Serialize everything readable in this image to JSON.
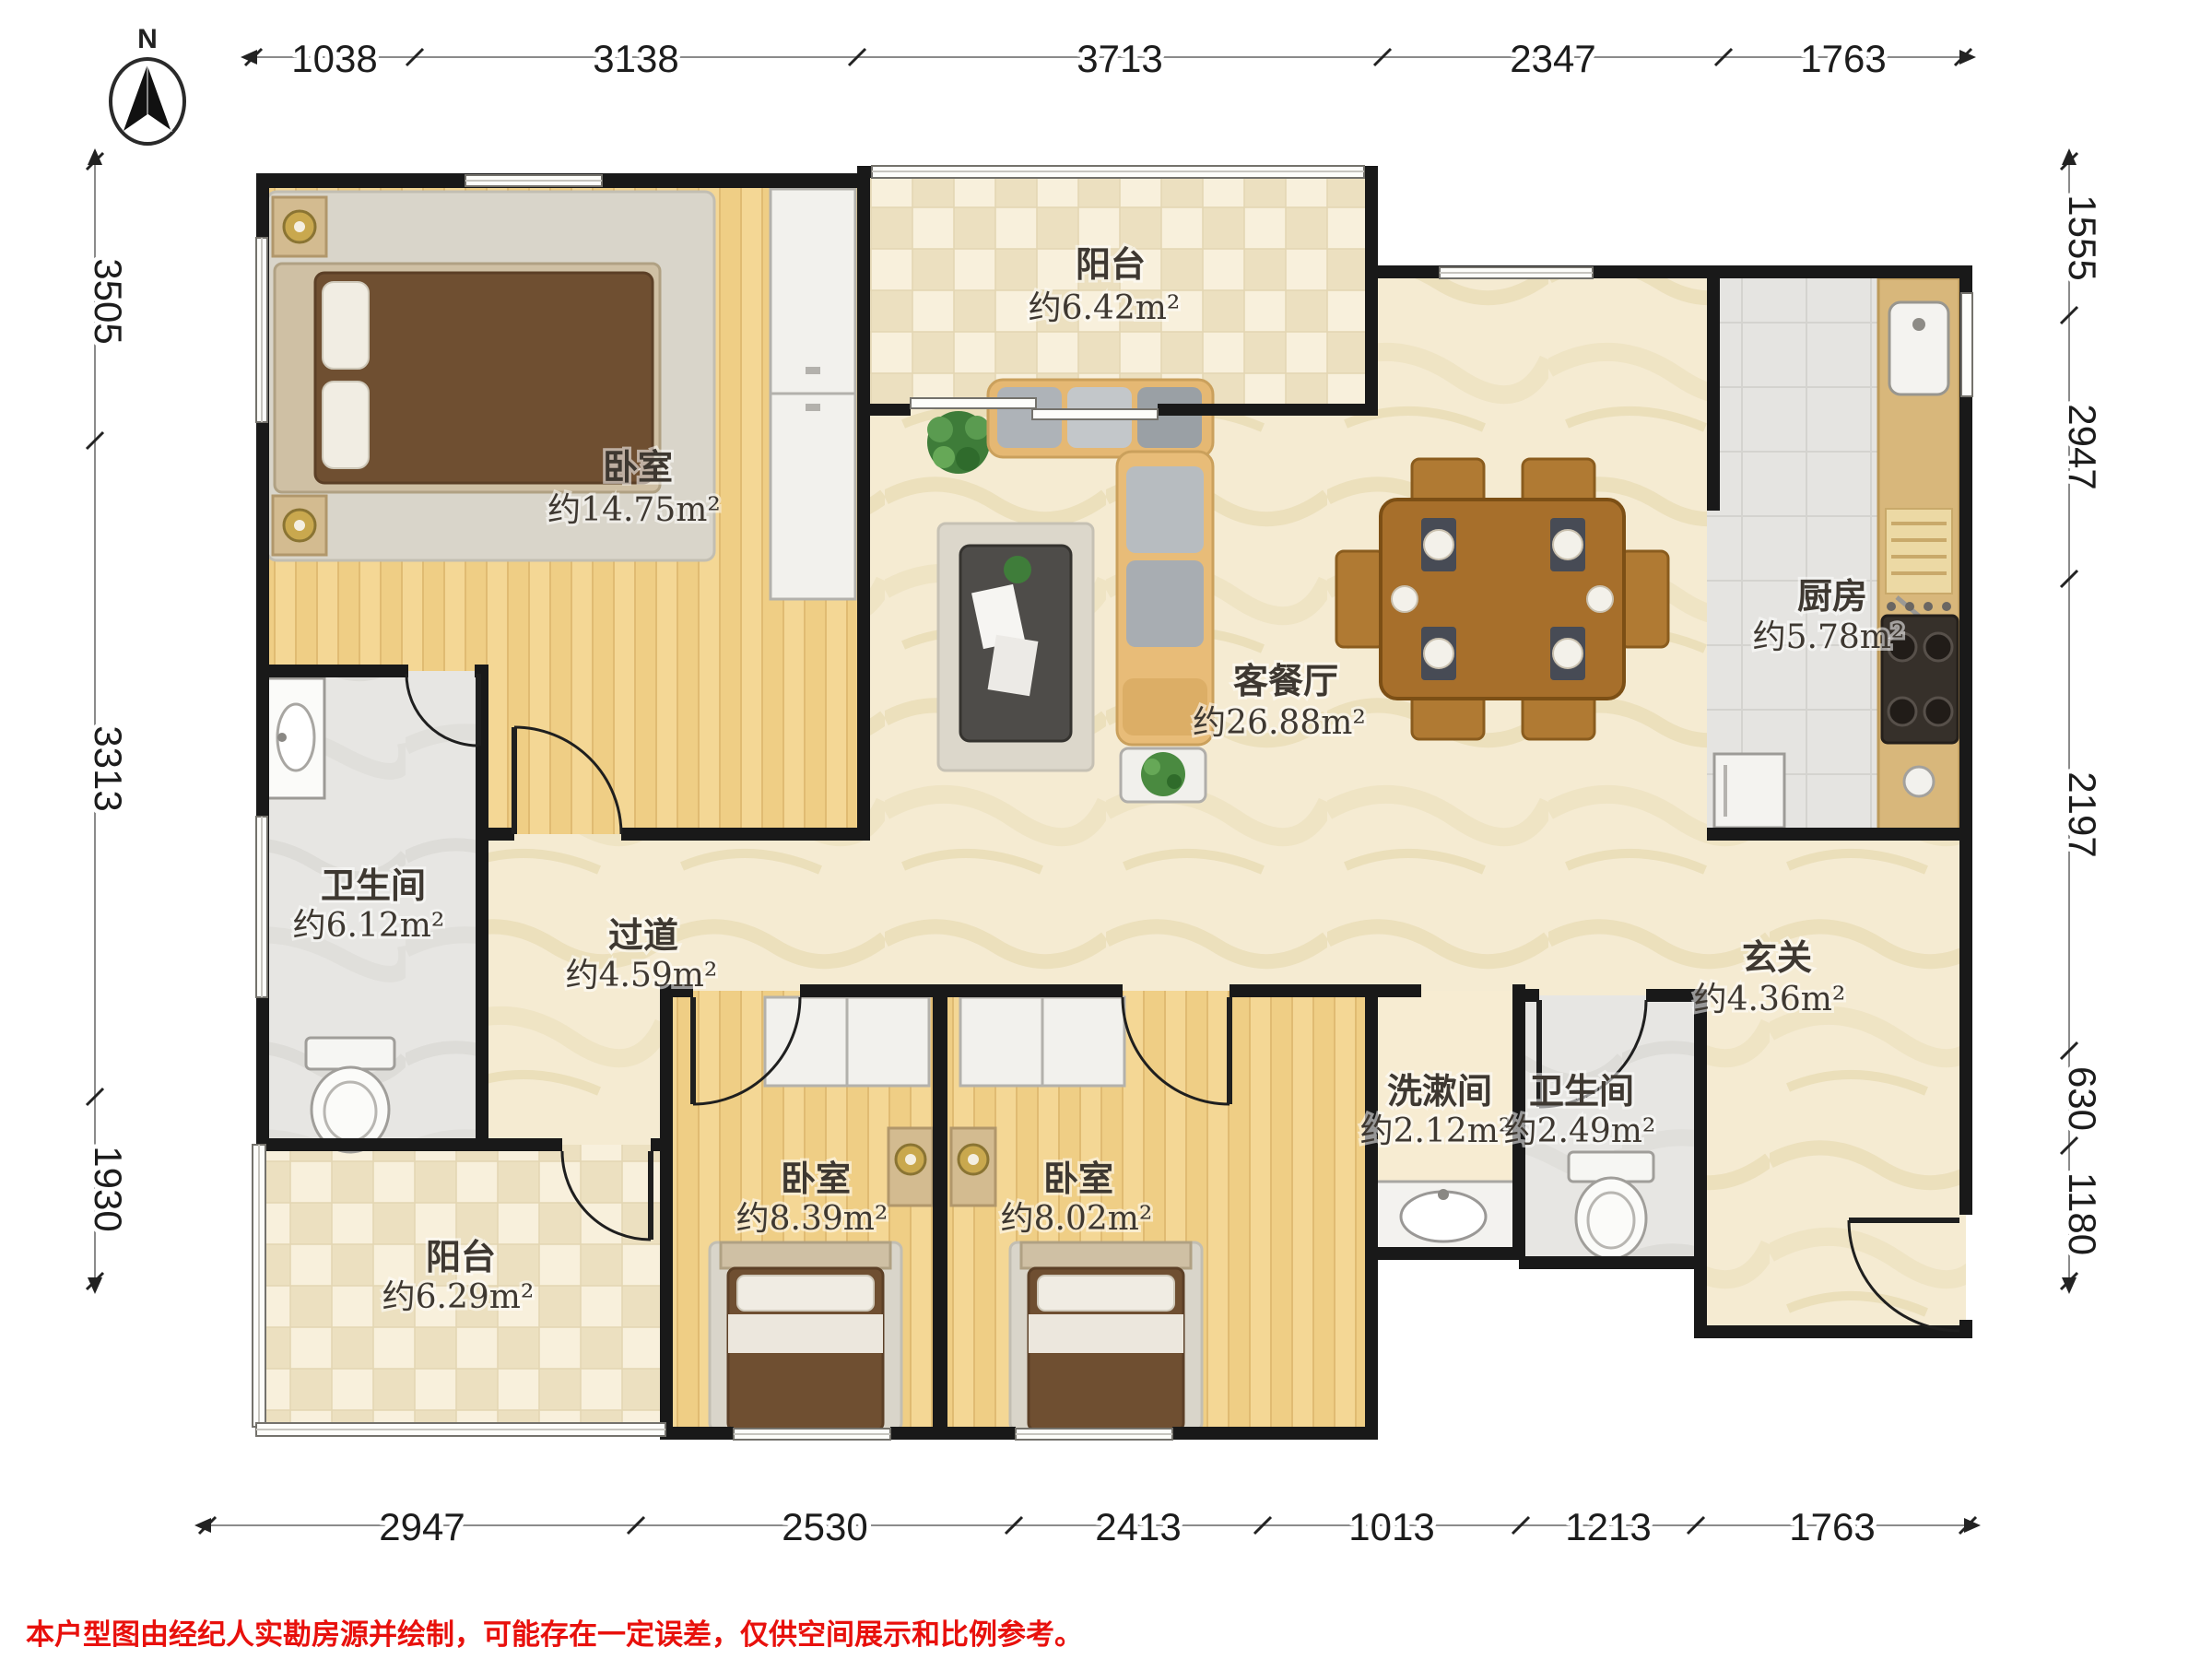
{
  "compass": {
    "label": "N"
  },
  "dimensions": {
    "top": [
      "1038",
      "3138",
      "3713",
      "2347",
      "1763"
    ],
    "left": [
      "3505",
      "3313",
      "1930"
    ],
    "right": [
      "1555",
      "2947",
      "2197",
      "630",
      "1180"
    ],
    "bottom": [
      "2947",
      "2530",
      "2413",
      "1013",
      "1213",
      "1763"
    ]
  },
  "rooms": [
    {
      "name": "阳台",
      "area": "约6.42m²"
    },
    {
      "name": "卧室",
      "area": "约14.75m²"
    },
    {
      "name": "客餐厅",
      "area": "约26.88m²"
    },
    {
      "name": "厨房",
      "area": "约5.78m²"
    },
    {
      "name": "卫生间",
      "area": "约6.12m²"
    },
    {
      "name": "过道",
      "area": "约4.59m²"
    },
    {
      "name": "玄关",
      "area": "约4.36m²"
    },
    {
      "name": "洗漱间",
      "area": "约2.12m²"
    },
    {
      "name": "卫生间",
      "area": "约2.49m²"
    },
    {
      "name": "卧室",
      "area": "约8.39m²"
    },
    {
      "name": "卧室",
      "area": "约8.02m²"
    },
    {
      "name": "阳台",
      "area": "约6.29m²"
    }
  ],
  "disclaimer": "本户型图由经纪人实勘房源并绘制，可能存在一定误差，仅供空间展示和比例参考。",
  "colors": {
    "wall": "#191919",
    "wood_floor": "#f4d795",
    "tile_light": "#f8f0dc",
    "tile_dark": "#ece0c0",
    "marble_floor": "#f5ebd2",
    "gray_floor": "#e7e6e3",
    "accent_red": "#e8100c"
  }
}
